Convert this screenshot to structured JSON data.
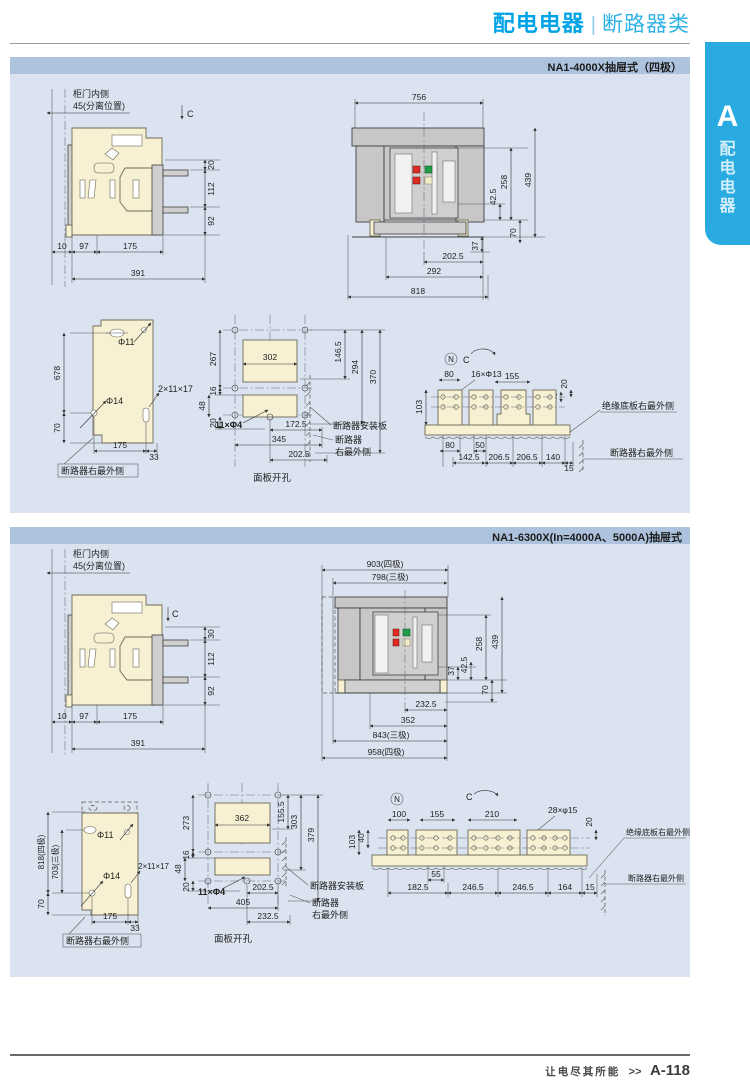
{
  "header": {
    "brand": "配电电器",
    "sep": "|",
    "section": "断路器类"
  },
  "tab": {
    "letter": "A",
    "label": "配电电器"
  },
  "footer": {
    "slogan": "让电尽其所能",
    "arrow": ">>",
    "page": "A-118"
  },
  "p1": {
    "title": "NA1-4000X抽屉式（四极）",
    "side": {
      "door": "柜门内侧",
      "pos": "45(分离位置)",
      "c": "C",
      "rd": [
        "20",
        "112",
        "92"
      ],
      "bd": [
        "10",
        "97",
        "175",
        "391"
      ]
    },
    "front": {
      "td": [
        "756"
      ],
      "rd": [
        "42.5",
        "258",
        "70",
        "439",
        "37"
      ],
      "bd": [
        "202.5",
        "292",
        "818"
      ]
    },
    "plate": {
      "d1": "Φ11",
      "d2": "Φ14",
      "slot": "2×11×17",
      "ld": [
        "678",
        "70"
      ],
      "bd": [
        "175",
        "33"
      ],
      "note": "断路器右最外侧"
    },
    "cut": {
      "ld": [
        "267",
        "16",
        "48",
        "20"
      ],
      "rd": [
        "146.5",
        "294",
        "370"
      ],
      "w": "302",
      "holes": "11×Φ4",
      "bd": [
        "172.5",
        "345",
        "202.5"
      ],
      "n1": "断路器安装板",
      "n2": "断路器",
      "n3": "右最外侧",
      "cap": "面板开孔"
    },
    "term": {
      "n": "N",
      "c": "C",
      "td": [
        "80",
        "16×Φ13",
        "155",
        "40",
        "20"
      ],
      "ld": [
        "103"
      ],
      "bd1": [
        "80",
        "50"
      ],
      "bd2": [
        "142.5",
        "206.5",
        "206.5",
        "140",
        "15"
      ],
      "n1": "绝缘底板右最外侧",
      "n2": "断路器右最外侧"
    }
  },
  "p2": {
    "title": "NA1-6300X(In=4000A、5000A)抽屉式",
    "side": {
      "door": "柜门内侧",
      "pos": "45(分离位置)",
      "c": "C",
      "rd": [
        "30",
        "112",
        "92"
      ],
      "bd": [
        "10",
        "97",
        "175",
        "391"
      ]
    },
    "front": {
      "td": [
        "903(四极)",
        "798(三极)"
      ],
      "rd": [
        "37",
        "42.5",
        "258",
        "439",
        "70"
      ],
      "bd": [
        "232.5",
        "352",
        "843(三极)",
        "958(四极)"
      ]
    },
    "plate": {
      "d1": "Φ11",
      "d2": "Φ14",
      "slot": "2×11×17",
      "ld": [
        "818(四极)",
        "703(三极)",
        "70"
      ],
      "bd": [
        "175",
        "33"
      ],
      "note": "断路器右最外侧"
    },
    "cut": {
      "ld": [
        "273",
        "16",
        "48",
        "20"
      ],
      "rd": [
        "155.5",
        "303",
        "379"
      ],
      "w": "362",
      "holes": "11×Φ4",
      "bd": [
        "202.5",
        "405",
        "232.5"
      ],
      "n1": "断路器安装板",
      "n2": "断路器",
      "n3": "右最外侧",
      "cap": "面板开孔"
    },
    "term": {
      "n": "N",
      "c": "C",
      "td": [
        "100",
        "155",
        "210",
        "28×φ15",
        "20"
      ],
      "ld": [
        "103",
        "40"
      ],
      "bd1": [
        "55"
      ],
      "bd2": [
        "182.5",
        "246.5",
        "246.5",
        "164",
        "15"
      ],
      "n1": "绝缘底板右最外侧",
      "n2": "断路器右最外侧"
    }
  }
}
